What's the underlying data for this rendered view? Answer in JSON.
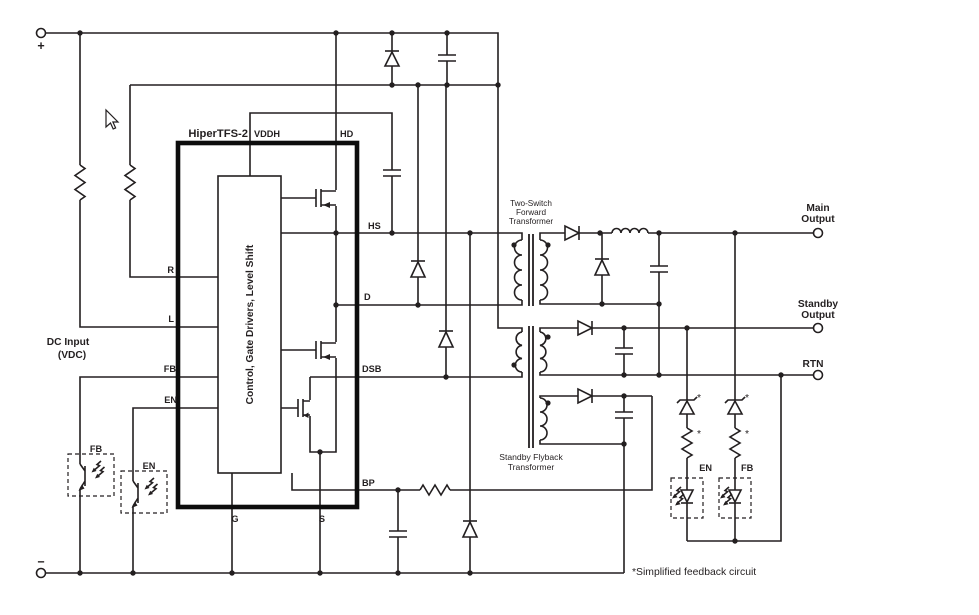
{
  "ic": {
    "name": "HiperTFS-2",
    "block_label": "Control, Gate Drivers, Level Shift",
    "pins": {
      "vddh": "VDDH",
      "hd": "HD",
      "hs": "HS",
      "d": "D",
      "dsb": "DSB",
      "bp": "BP",
      "r": "R",
      "l": "L",
      "fb": "FB",
      "en": "EN",
      "g": "G",
      "s": "S"
    }
  },
  "input": {
    "label": "DC Input",
    "label2": "(VDC)",
    "plus": "+",
    "minus": "−"
  },
  "transformers": {
    "forward": {
      "line1": "Two-Switch",
      "line2": "Forward",
      "line3": "Transformer"
    },
    "flyback": {
      "line1": "Standby Flyback",
      "line2": "Transformer"
    }
  },
  "outputs": {
    "main": {
      "line1": "Main",
      "line2": "Output"
    },
    "standby": {
      "line1": "Standby",
      "line2": "Output"
    },
    "rtn": "RTN"
  },
  "feedback": {
    "en": "EN",
    "fb": "FB",
    "asterisk": "*",
    "note": "*Simplified feedback circuit"
  },
  "optocouplers": {
    "fb": "FB",
    "en": "EN"
  },
  "colors": {
    "line": "#231f20",
    "bg": "#ffffff"
  }
}
